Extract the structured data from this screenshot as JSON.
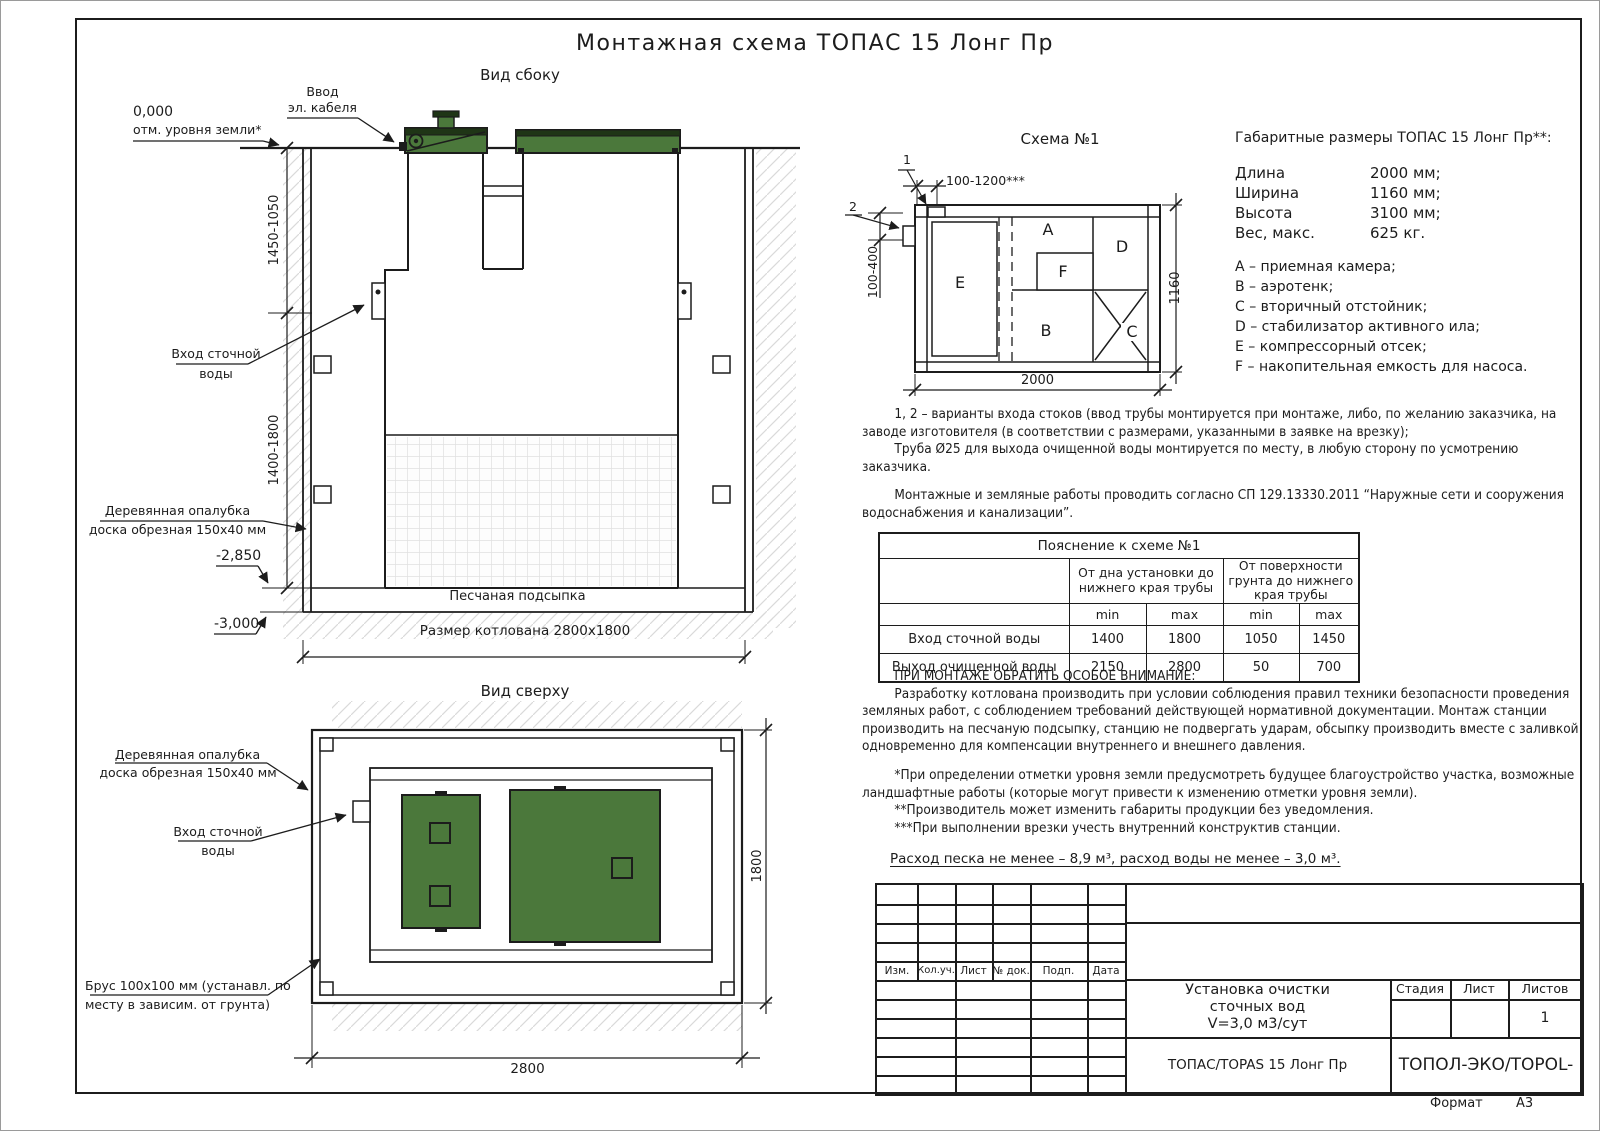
{
  "meta": {
    "sheet_title": "Монтажная схема ТОПАС 15 Лонг Пр"
  },
  "side_view": {
    "caption": "Вид сбоку",
    "cable_label_1": "Ввод",
    "cable_label_2": "эл. кабеля",
    "zero_mark": "0,000",
    "zero_desc": "отм. уровня земли*",
    "dim_upper": "1450-1050",
    "dim_lower": "1400-1800",
    "inlet_1": "Вход сточной",
    "inlet_2": "воды",
    "formwork_1": "Деревянная опалубка",
    "formwork_2": "доска обрезная 150х40 мм",
    "mark_minus_2850": "-2,850",
    "mark_minus_3000": "-3,000",
    "sand_label": "Песчаная подсыпка",
    "pit_label": "Размер котлована 2800х1800"
  },
  "schema": {
    "caption": "Схема №1",
    "point_1": "1",
    "point_2": "2",
    "dim_top": "100-1200***",
    "dim_side": "100-400",
    "dim_len": "2000",
    "dim_wid": "1160",
    "comp_a": "A",
    "comp_b": "B",
    "comp_c": "C",
    "comp_d": "D",
    "comp_e": "E",
    "comp_f": "F"
  },
  "overall": {
    "heading": "Габаритные размеры ТОПАС 15 Лонг Пр**:",
    "rows": [
      {
        "label": "Длина",
        "value": "2000 мм;"
      },
      {
        "label": "Ширина",
        "value": "1160 мм;"
      },
      {
        "label": "Высота",
        "value": "3100 мм;"
      },
      {
        "label": "Вес, макс.",
        "value": "625 кг."
      }
    ],
    "legend": [
      "A – приемная камера;",
      "B – аэротенк;",
      "C – вторичный отстойник;",
      "D – стабилизатор активного ила;",
      "E – компрессорный отсек;",
      "F – накопительная емкость для насоса."
    ]
  },
  "notes": {
    "variants": "1, 2 – варианты входа  стоков (ввод трубы монтируется при монтаже, либо, по желанию заказчика, на заводе изготовителя (в соответствии с размерами, указанными в заявке на врезку);",
    "pipe": "Труба Ø25 для выхода очищенной воды монтируется по месту, в любую сторону по усмотрению заказчика.",
    "works": "Монтажные и земляные работы проводить согласно СП 129.13330.2011 “Наружные сети и сооружения водоснабжения и канализации”."
  },
  "table": {
    "title": "Пояснение к схеме №1",
    "group1": "От дна установки до нижнего края трубы",
    "group2": "От поверхности грунта до нижнего края трубы",
    "min": "min",
    "max": "max",
    "rows": [
      {
        "label": "Вход сточной воды",
        "v1": "1400",
        "v2": "1800",
        "v3": "1050",
        "v4": "1450"
      },
      {
        "label": "Выход очищенной воды",
        "v1": "2150",
        "v2": "2800",
        "v3": "50",
        "v4": "700"
      }
    ]
  },
  "attention": {
    "heading": "ПРИ МОНТАЖЕ ОБРАТИТЬ ОСОБОЕ ВНИМАНИЕ:",
    "body": "Разработку котлована производить при условии соблюдения правил техники безопасности проведения земляных работ, с соблюдением требований действующей нормативной документации. Монтаж станции производить на песчаную подсыпку, станцию не подвергать ударам, обсыпку производить вместе с заливкой одновременно для компенсации внутреннего и внешнего давления.",
    "footnote1": "*При определении отметки уровня земли предусмотреть будущее благоустройство участка, возможные ландшафтные работы (которые могут привести к изменению отметки уровня земли).",
    "footnote2": "**Производитель может изменить габариты продукции без уведомления.",
    "footnote3": "***При выполнении врезки учесть внутренний конструктив станции.",
    "consumption": "Расход песка не менее – 8,9 м³, расход воды не менее – 3,0 м³."
  },
  "top_view": {
    "caption": "Вид сверху",
    "formwork_1": "Деревянная опалубка",
    "formwork_2": "доска обрезная 150х40 мм",
    "inlet_1": "Вход сточной",
    "inlet_2": "воды",
    "beam_1": "Брус 100х100 мм (устанавл. по",
    "beam_2": "месту в зависим. от грунта)",
    "dim_len": "2800",
    "dim_wid": "1800"
  },
  "title_block": {
    "cols": [
      "Изм.",
      "Кол.уч.",
      "Лист",
      "№ док.",
      "Подп.",
      "Дата"
    ],
    "doc_1": "Установка очистки",
    "doc_2": "сточных вод",
    "doc_3": "V=3,0 м3/сут",
    "stage": "Стадия",
    "sheet": "Лист",
    "sheets": "Листов",
    "sheets_value": "1",
    "model": "ТОПАС/TOPAS 15 Лонг Пр",
    "brand": "ТОПОЛ-ЭКО/TOPOL-ECO",
    "format_label": "Формат",
    "format_value": "А3"
  },
  "colors": {
    "lid_green": "#4b783b",
    "lid_dark": "#1f3516",
    "ink": "#1c1c1c"
  }
}
